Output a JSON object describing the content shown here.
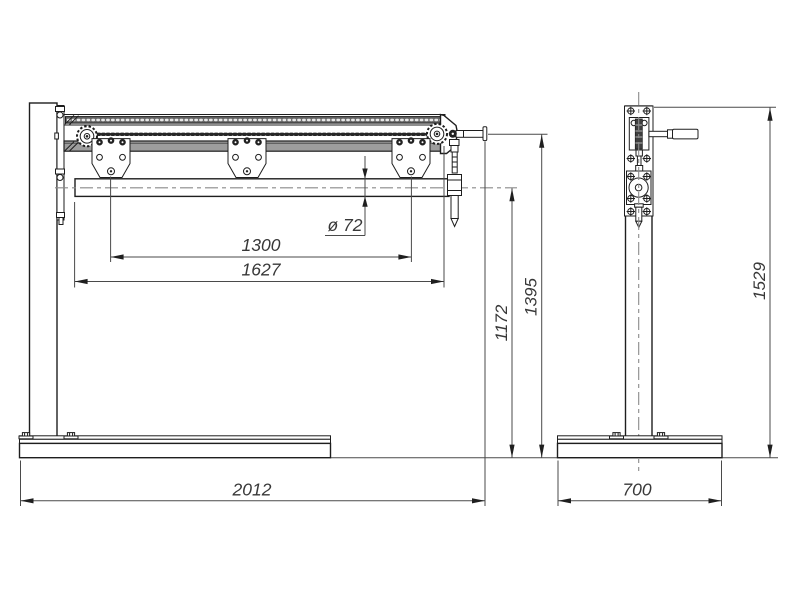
{
  "colors": {
    "line": "#1e1e1e",
    "dimension_line": "#4a4a4a",
    "centerline": "#8a8a8a",
    "guide_bar_fill": "#9d9d9d",
    "chain_band_fill": "#686868",
    "background": "#ffffff"
  },
  "front_view": {
    "dim_plate_spacing": "1300",
    "dim_shaft_span": "1627",
    "dim_shaft_diameter": "ø 72",
    "dim_shaft_axis_height": "1172",
    "dim_crank_axis_height": "1395",
    "dim_overall_length": "2012"
  },
  "side_view": {
    "dim_overall_height": "1529",
    "dim_base_depth": "700"
  }
}
